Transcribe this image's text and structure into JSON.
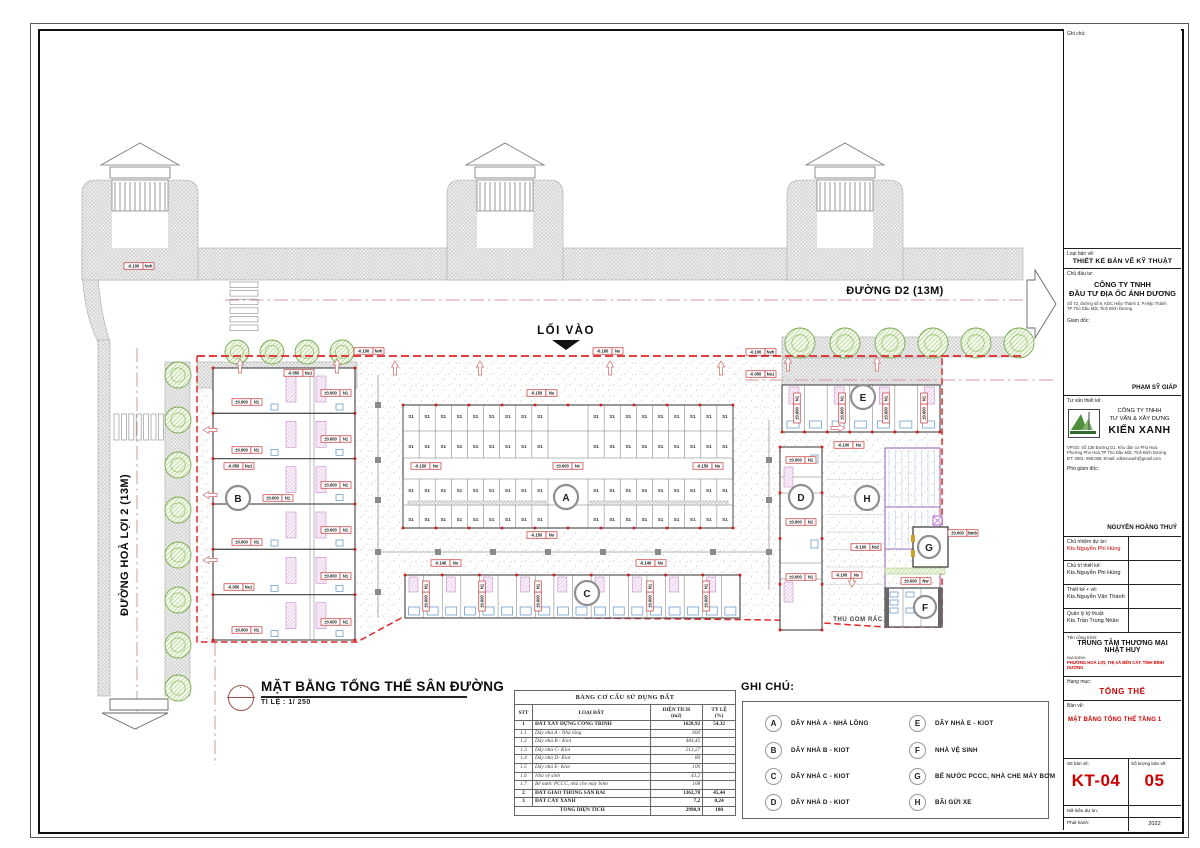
{
  "plan": {
    "road_top": "ĐƯỜNG D2 (13M)",
    "road_left": "ĐƯỜNG HOÀ LỢI 2 (13M)",
    "entrance": "LỐI VÀO",
    "trash_area": "THU GOM RÁC",
    "stall": "S1",
    "blocks": {
      "A": "A",
      "B": "B",
      "C": "C",
      "D": "D",
      "E": "E",
      "F": "F",
      "G": "G",
      "H": "H"
    },
    "markers": [
      {
        "x": 329,
        "y": 321,
        "v": "-0.100",
        "c": "Nvh"
      },
      {
        "x": 568,
        "y": 321,
        "v": "-0.160",
        "c": "Ns"
      },
      {
        "x": 721,
        "y": 322,
        "v": "-0.100",
        "c": "Nvh"
      },
      {
        "x": 721,
        "y": 344,
        "v": "-0.050",
        "c": "Ns1"
      },
      {
        "x": 259,
        "y": 343,
        "v": "-0.050",
        "c": "Ns1"
      },
      {
        "x": 99,
        "y": 236,
        "v": "-0.100",
        "c": "Nvh"
      },
      {
        "x": 502,
        "y": 363,
        "v": "-0.150",
        "c": "Ns"
      },
      {
        "x": 386,
        "y": 436,
        "v": "-0.150",
        "c": "Ns"
      },
      {
        "x": 528,
        "y": 436,
        "v": "±0.000",
        "c": "Nc"
      },
      {
        "x": 668,
        "y": 436,
        "v": "-0.150",
        "c": "Ns"
      },
      {
        "x": 502,
        "y": 505,
        "v": "-0.150",
        "c": "Ns"
      },
      {
        "x": 406,
        "y": 533,
        "v": "-0.140",
        "c": "Ns"
      },
      {
        "x": 611,
        "y": 533,
        "v": "-0.140",
        "c": "Ns"
      },
      {
        "x": 809,
        "y": 415,
        "v": "-0.100",
        "c": "Ns"
      },
      {
        "x": 826,
        "y": 517,
        "v": "-0.100",
        "c": "Ns2"
      },
      {
        "x": 807,
        "y": 545,
        "v": "-0.100",
        "c": "Ns"
      },
      {
        "x": 923,
        "y": 503,
        "v": "±0.000",
        "c": "Nmb"
      },
      {
        "x": 876,
        "y": 551,
        "v": "±0.000",
        "c": "Nw"
      },
      {
        "x": 199,
        "y": 436,
        "v": "-0.050",
        "c": "Ns1"
      },
      {
        "x": 199,
        "y": 557,
        "v": "-0.050",
        "c": "Ns1"
      },
      {
        "x": 207,
        "y": 372,
        "v": "±0.000",
        "c": "N1"
      },
      {
        "x": 207,
        "y": 420,
        "v": "±0.000",
        "c": "N1"
      },
      {
        "x": 238,
        "y": 468,
        "v": "±0.000",
        "c": "N1"
      },
      {
        "x": 207,
        "y": 512,
        "v": "±0.000",
        "c": "N1"
      },
      {
        "x": 207,
        "y": 600,
        "v": "±0.000",
        "c": "N1"
      },
      {
        "x": 296,
        "y": 363,
        "v": "±0.000",
        "c": "N1"
      },
      {
        "x": 296,
        "y": 409,
        "v": "±0.000",
        "c": "N1"
      },
      {
        "x": 296,
        "y": 455,
        "v": "±0.000",
        "c": "N1"
      },
      {
        "x": 296,
        "y": 500,
        "v": "±0.000",
        "c": "N1"
      },
      {
        "x": 296,
        "y": 546,
        "v": "±0.000",
        "c": "N1"
      },
      {
        "x": 296,
        "y": 592,
        "v": "±0.000",
        "c": "N1"
      },
      {
        "x": 761,
        "y": 430,
        "v": "±0.000",
        "c": "N1"
      },
      {
        "x": 761,
        "y": 492,
        "v": "±0.000",
        "c": "N1"
      },
      {
        "x": 761,
        "y": 547,
        "v": "±0.000",
        "c": "N1"
      },
      {
        "x": 757,
        "y": 378,
        "v": "±0.000",
        "c": "N1",
        "r": -90
      },
      {
        "x": 802,
        "y": 378,
        "v": "±0.000",
        "c": "N1",
        "r": -90
      },
      {
        "x": 846,
        "y": 378,
        "v": "±0.000",
        "c": "N1",
        "r": -90
      },
      {
        "x": 884,
        "y": 378,
        "v": "±0.000",
        "c": "N1",
        "r": -90
      },
      {
        "x": 386,
        "y": 566,
        "v": "±0.000",
        "c": "N1",
        "r": -90
      },
      {
        "x": 442,
        "y": 566,
        "v": "±0.000",
        "c": "N1",
        "r": -90
      },
      {
        "x": 498,
        "y": 566,
        "v": "±0.000",
        "c": "N1",
        "r": -90
      },
      {
        "x": 610,
        "y": 566,
        "v": "±0.000",
        "c": "N1",
        "r": -90
      },
      {
        "x": 666,
        "y": 566,
        "v": "±0.000",
        "c": "N1",
        "r": -90
      }
    ]
  },
  "drawing_title": {
    "title": "MẶT BẰNG TỔNG THỂ SÂN ĐƯỜNG",
    "scale": "TỈ LỆ : 1/ 250"
  },
  "land_table": {
    "title": "BẢNG CƠ CẤU SỬ DỤNG ĐẤT",
    "headers": {
      "stt": "STT",
      "type": "LOẠI ĐẤT",
      "area1": "DIỆN TÍCH",
      "area2": "(m2)",
      "ratio1": "TỶ LỆ",
      "ratio2": "(%)"
    },
    "rows": [
      {
        "stt": "1",
        "name": "ĐẤT XÂY DỰNG CÔNG TRÌNH",
        "area": "1628,92",
        "ratio": "54,32"
      },
      {
        "stt": "1.1",
        "name": "Dãy nhà A - Nhà lồng",
        "area": "600",
        "ratio": ""
      },
      {
        "stt": "1.2",
        "name": "Dãy nhà B - Kiot",
        "area": "484,45",
        "ratio": ""
      },
      {
        "stt": "1.3",
        "name": "Dãy nhà C- Kiot",
        "area": "213,27",
        "ratio": ""
      },
      {
        "stt": "1.4",
        "name": "Dãy nhà D- Kiot",
        "area": "80",
        "ratio": ""
      },
      {
        "stt": "1.5",
        "name": "Dãy nhà E- Kiot",
        "area": "100",
        "ratio": ""
      },
      {
        "stt": "1.6",
        "name": "Nhà vệ sinh",
        "area": "43,2",
        "ratio": ""
      },
      {
        "stt": "1.7",
        "name": "Bể nước PCCC, nhà che máy bơm",
        "area": "108",
        "ratio": ""
      },
      {
        "stt": "2",
        "name": "ĐẤT GIAO THÔNG SÂN BÃI",
        "area": "1362,78",
        "ratio": "45,44"
      },
      {
        "stt": "3",
        "name": "ĐẤT CÂY XANH",
        "area": "7,2",
        "ratio": "0,24"
      }
    ],
    "total": {
      "label": "TỔNG DIỆN TÍCH",
      "area": "2998,9",
      "ratio": "100"
    }
  },
  "legend": {
    "title": "GHI CHÚ:",
    "items": [
      {
        "key": "A",
        "label": "DÃY NHÀ A - NHÀ LỒNG"
      },
      {
        "key": "B",
        "label": "DÃY NHÀ B - KIOT"
      },
      {
        "key": "C",
        "label": "DÃY NHÀ C - KIOT"
      },
      {
        "key": "D",
        "label": "DÃY NHÀ D - KIOT"
      },
      {
        "key": "E",
        "label": "DÃY NHÀ E - KIOT"
      },
      {
        "key": "F",
        "label": "NHÀ VỆ SINH"
      },
      {
        "key": "G",
        "label": "BỂ NƯỚC PCCC, NHÀ CHE MÁY BƠM"
      },
      {
        "key": "H",
        "label": "BÃI GỬI XE"
      }
    ]
  },
  "titleblock": {
    "note_label": "Ghi chú:",
    "type_label": "Loại bản vẽ:",
    "type_value": "THIẾT KẾ BẢN VẼ KỸ THUẬT",
    "investor_label": "Chủ đầu tư:",
    "investor_1": "CÔNG TY TNHH",
    "investor_2": "ĐẦU TƯ ĐỊA ỐC ÁNH DƯƠNG",
    "investor_addr_1": "Số 72, đường số 8, KDC Hiệp Thành 3, P.Hiệp Thành",
    "investor_addr_2": "TP Thủ Dầu Một, Tỉnh Bình Dương",
    "director_label": "Giám đốc:",
    "director_name": "PHẠM SỸ GIÁP",
    "consult_label": "Tư vấn thiết kế:",
    "consult_1": "CÔNG TY TNHH",
    "consult_2": "TƯ VẤN & XÂY DỰNG",
    "consult_name": "KIẾN XANH",
    "consult_addr_1": "VPGD: Số 138 Đường D1, Khu dân cư Phú Hoà,",
    "consult_addr_2": "Phường Phú Hoà,TP Thủ Dầu Một, Tỉnh Bình Dương",
    "consult_addr_3": "ĐT: 0901. 698.069; Email: xdkienxanh@gmail.com",
    "deputy_label": "Phó giám đốc:",
    "deputy_name": "NGUYỄN HOÀNG THUỶ",
    "rows": [
      {
        "label": "Chủ nhiệm dự án:",
        "value": "Kts.Nguyễn Phi Hùng"
      },
      {
        "label": "Chủ trì thiết kế:",
        "value": "Kts.Nguyễn Phi Hùng"
      },
      {
        "label": "Thiết kế + vẽ:",
        "value": "Kts.Nguyễn Văn Thành"
      },
      {
        "label": "Quản lý kỹ thuật:",
        "value": "Kts.Trần Trung Nhân"
      }
    ],
    "project_label": "Tên công trình:",
    "project_1": "TRUNG TÂM THƯƠNG MẠI",
    "project_2": "NHẬT HUY",
    "location_label": "ĐỊA ĐIỂM:",
    "location_value": "PHƯỜNG HOÀ LỢI, THỊ XÃ BẾN CÁT, TỈNH BÌNH DƯƠNG",
    "category_label": "Hạng mục:",
    "category_value": "TỔNG THỂ",
    "sheet_label": "Bản vẽ:",
    "sheet_value": "MẶT BẰNG TỔNG THỂ TẦNG 1",
    "no_label": "Stt bản vẽ:",
    "no_value": "KT-04",
    "qty_label": "Số lượng bản vẽ:",
    "qty_value": "05",
    "code_label": "Mã hiệu dự án:",
    "issue_label": "Phát hành:",
    "issue_value": "2022"
  }
}
